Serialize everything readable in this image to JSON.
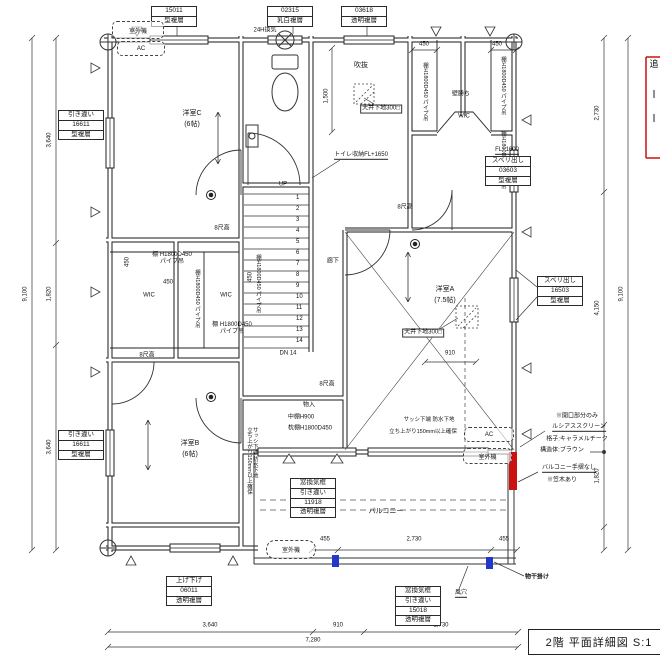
{
  "title_block": {
    "text": "2階 平面詳細図 S:1"
  },
  "side_note_cut": {
    "text": "追"
  },
  "window_tags": {
    "top_left": {
      "r1": "15011",
      "r2": "型複層"
    },
    "top_mid": {
      "r1": "02315",
      "r2": "乳白複層"
    },
    "top_right": {
      "r1": "03618",
      "r2": "透明複層"
    },
    "left_upper": {
      "r1": "引き違い",
      "r2": "16611",
      "r3": "型複層"
    },
    "left_lower": {
      "r1": "引き違い",
      "r2": "16611",
      "r3": "型複層"
    },
    "right_upper_fl": "FL+1600",
    "right_upper": {
      "r1": "スベリ出し",
      "r2": "03603",
      "r3": "型複層"
    },
    "right_mid": {
      "r1": "スベリ出し",
      "r2": "16503",
      "r3": "型複層"
    },
    "balcony": {
      "r1": "窓換気框",
      "r2": "引き違い",
      "r3": "11918",
      "r4": "透明複層"
    },
    "bottom_mid": {
      "r1": "窓換気框",
      "r2": "引き違い",
      "r3": "15018",
      "r4": "透明複層"
    },
    "bottom_left": {
      "r1": "上げ下げ",
      "r2": "06011",
      "r3": "透明複層"
    }
  },
  "rooms": {
    "c_name": "洋室C",
    "c_size": "(6帖)",
    "a_name": "洋室A",
    "a_size": "(7.5帖)",
    "b_name": "洋室B",
    "b_size": "(6帖)",
    "wic": "WIC",
    "hall": "廊下",
    "void_space": "吹抜",
    "balcony": "バルコニー",
    "closet": "物入"
  },
  "notes": {
    "outdoor_unit": "室外機",
    "ac": "AC",
    "vent24": "24H換気",
    "ceiling_base": "天井下地300□",
    "toilet_storage": "トイレ収納FL+1650",
    "wall_priority": "壁勝ち",
    "shelf_pipe_v": "棚H1800D450 パイプ吊",
    "shelf_pipe_l1": "棚 H1800D450",
    "shelf_pipe_l2": "パイプ吊",
    "shelf_mid": "中棚H900",
    "shelf_pillow": "枕棚H1800D450",
    "h8": "8尺高",
    "up": "UP",
    "dn": "DN 14",
    "sash_l1": "サッシ下端 防水下地",
    "sash_l2": "立ち上がり150mm以上確保",
    "open1": "※開口部分のみ",
    "open2": "ルシアススクリーン",
    "open3": "格子:キャラメルチーク",
    "open4": "構造体:ブラウン",
    "rail1": "バルコニー手摺なし",
    "rail2": "※笠木あり",
    "pole": "物干掛け",
    "vent_hole": "風穴"
  },
  "dims": {
    "left_total": "9,100",
    "l1": "3,640",
    "l2": "1,820",
    "l3": "3,640",
    "right_total": "9,100",
    "r1": "2,730",
    "r2": "4,150",
    "r3": "1,820",
    "b1": "3,640",
    "b2": "910",
    "b3": "2,730",
    "b_total": "7,280",
    "bal1": "455",
    "bal2": "2,730",
    "bal3": "455",
    "d450": "450",
    "d910": "910",
    "d1500": "1,500"
  },
  "stairs": {
    "steps": [
      "1",
      "2",
      "3",
      "4",
      "5",
      "6",
      "7",
      "8",
      "9",
      "10",
      "11",
      "12",
      "13",
      "14"
    ]
  },
  "colors": {
    "accent_red": "#cc1111",
    "accent_blue": "#2238c8",
    "line": "#1a1a1a"
  }
}
